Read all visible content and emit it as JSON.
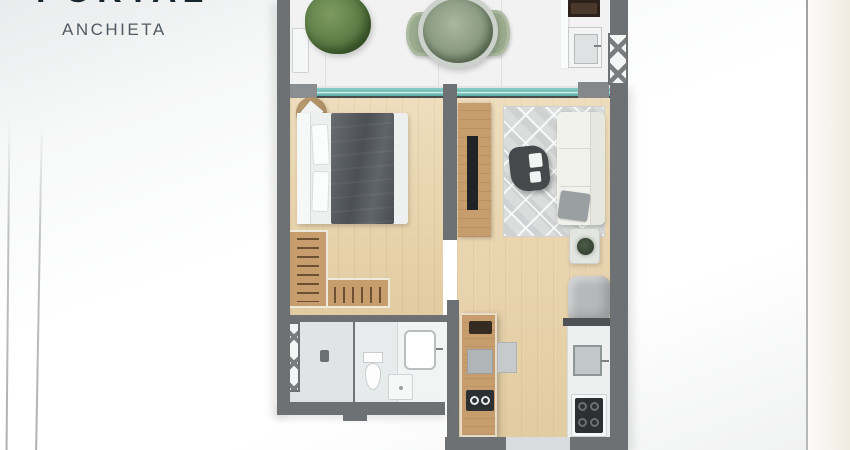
{
  "brand": {
    "title": "PORTAL",
    "subtitle": "ANCHIETA"
  },
  "palette": {
    "brand_navy": "#17262f",
    "brand_gray": "#525b63",
    "wall": "#6e7173",
    "wood_floor": "#e9d2a6",
    "wood_cabinet": "#c79d6d",
    "balcony_floor": "#f1f2f1",
    "glass_teal": "#74c2bb",
    "bath_floor": "#e8ebeb",
    "rug_gray": "#dadddc",
    "sofa_cream": "#f1f2ec",
    "bed_blanket": "#565b5f",
    "plant_green": "#5c7c46",
    "chair_sage": "#9aab8e",
    "appliance_dark": "#2d3032",
    "grill_brown": "#4a382a"
  },
  "floorplan": {
    "areas": [
      "balcony",
      "gourmet-corner",
      "bedroom",
      "living-room",
      "closet",
      "bathroom",
      "kitchen"
    ],
    "furniture": [
      "bush-plant",
      "bench",
      "dining-chairs",
      "dining-table-with-plant",
      "grill",
      "gourmet-sink",
      "double-bed",
      "pouf",
      "tv-panel",
      "rug",
      "sofa",
      "coffee-table",
      "side-table-plant",
      "armchair",
      "wardrobe",
      "shower",
      "toilet",
      "vanity-basin",
      "kitchen-island",
      "microwave",
      "cooktop",
      "counter-sink",
      "stove",
      "entry-door"
    ]
  }
}
